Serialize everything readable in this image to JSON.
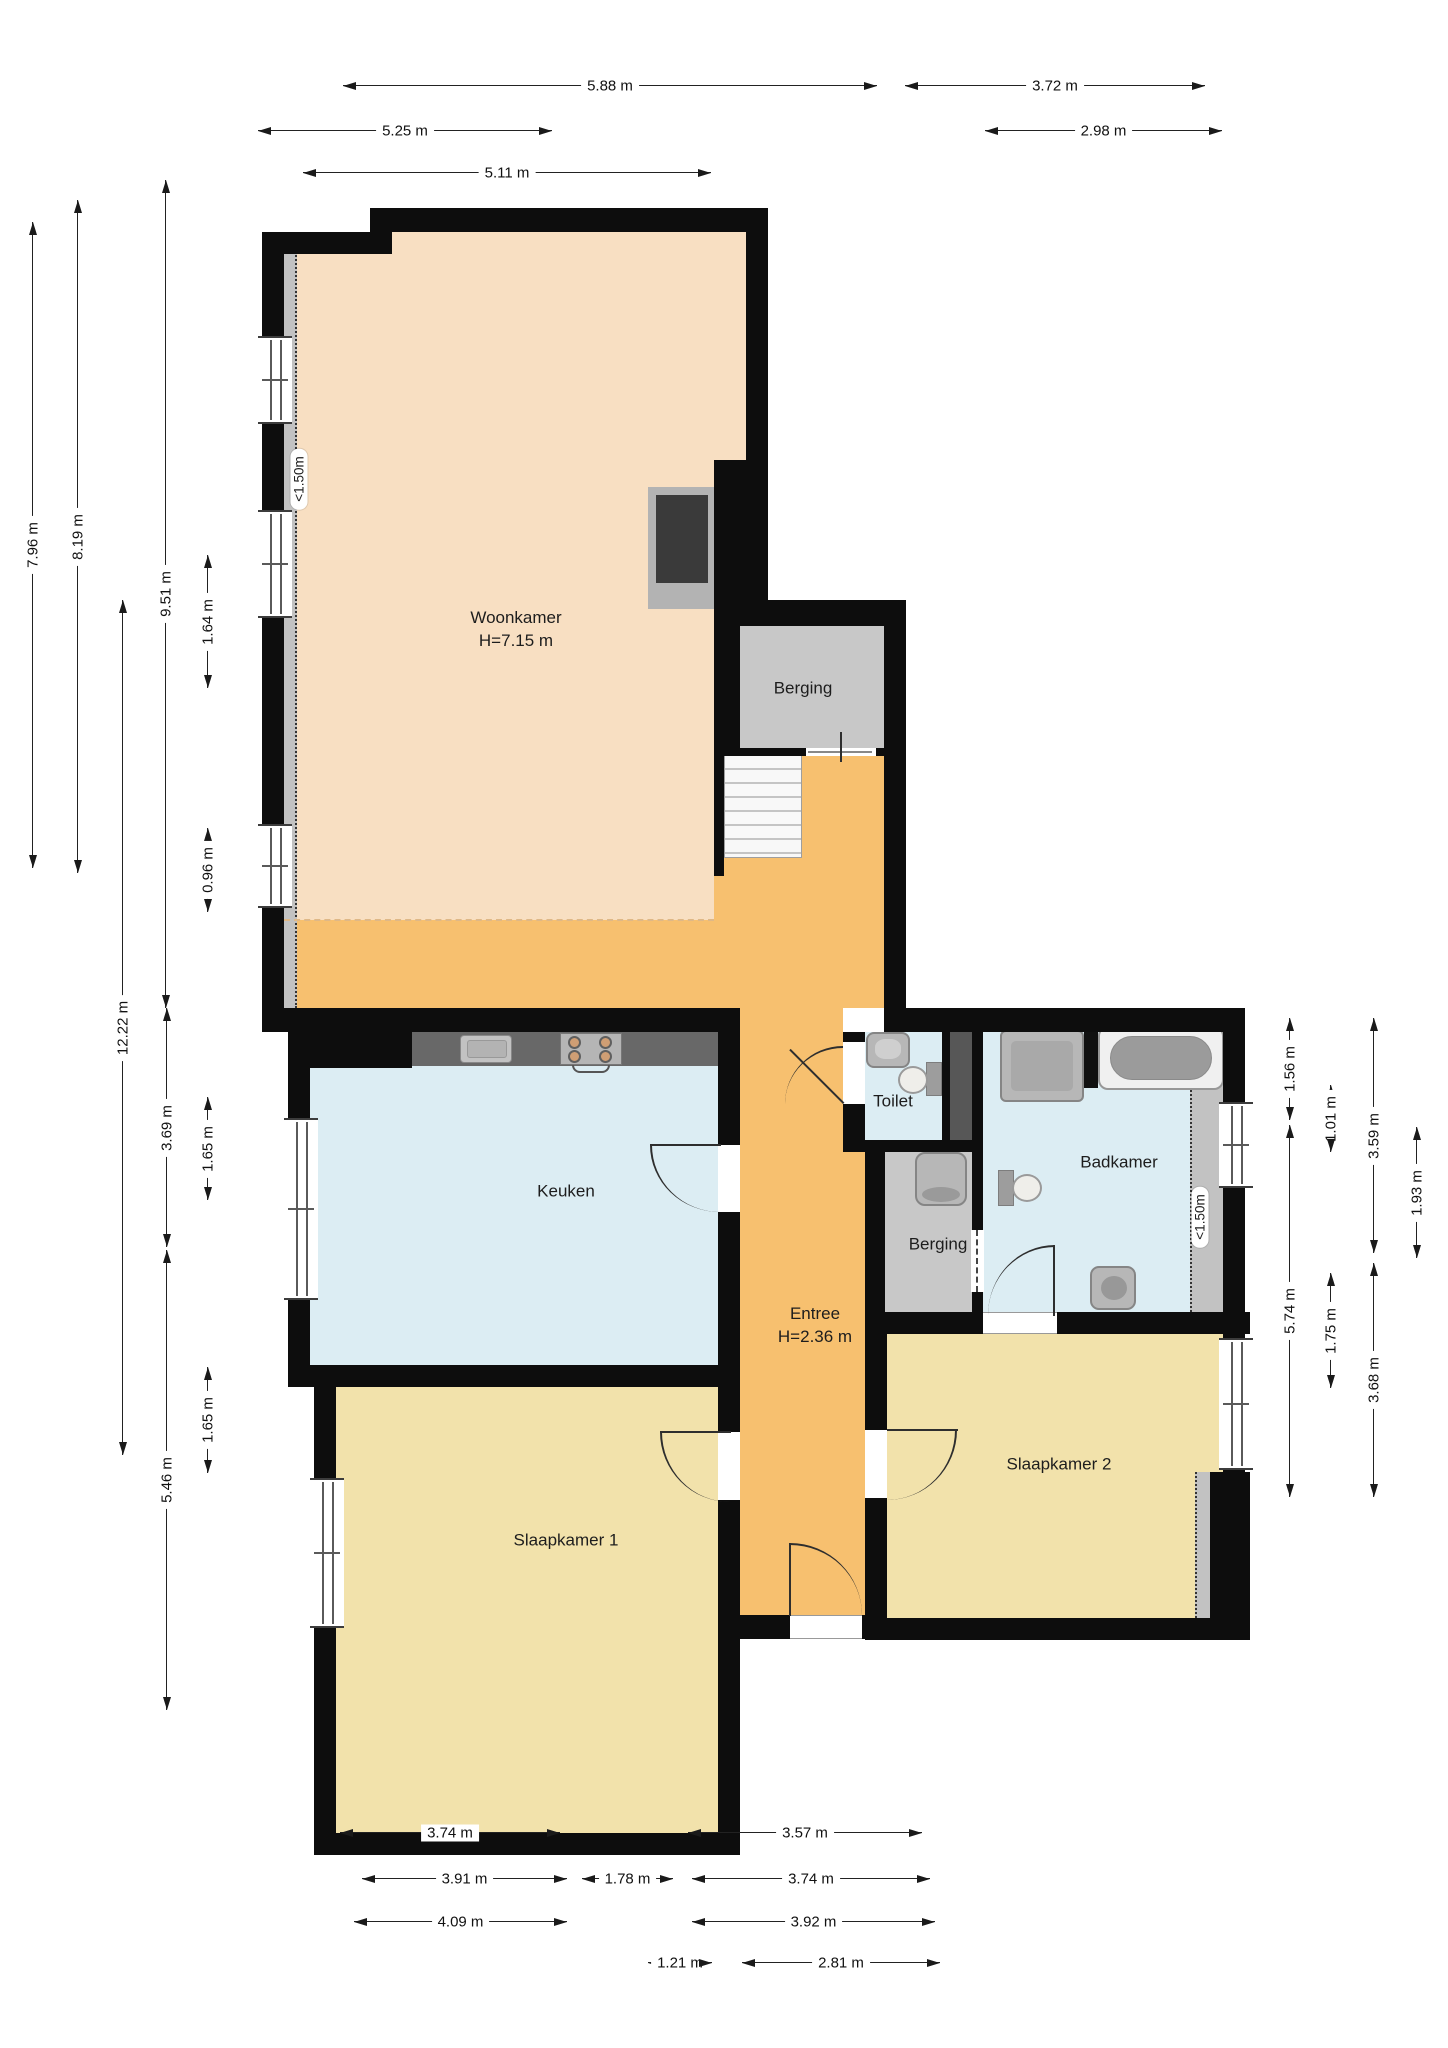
{
  "rooms": {
    "woonkamer": {
      "label": "Woonkamer",
      "height": "H=7.15 m"
    },
    "berging_boven": {
      "label": "Berging"
    },
    "keuken": {
      "label": "Keuken"
    },
    "toilet": {
      "label": "Toilet"
    },
    "badkamer": {
      "label": "Badkamer"
    },
    "berging_klein": {
      "label": "Berging"
    },
    "entree": {
      "label": "Entree",
      "height": "H=2.36 m"
    },
    "slaapkamer1": {
      "label": "Slaapkamer 1"
    },
    "slaapkamer2": {
      "label": "Slaapkamer 2"
    }
  },
  "annotations": {
    "low_ceiling_woonkamer": "<1.50m",
    "low_ceiling_badkamer": "<1.50m"
  },
  "dims": {
    "top": [
      "5.88 m",
      "3.72 m",
      "5.25 m",
      "2.98 m",
      "5.11 m"
    ],
    "left": [
      "7.96 m",
      "8.19 m",
      "12.22 m",
      "9.51 m",
      "1.64 m",
      "0.96 m",
      "3.69 m",
      "1.65 m",
      "5.46 m",
      "1.65 m"
    ],
    "right": [
      "1.56 m",
      "1.01 m",
      "3.59 m",
      "1.93 m",
      "5.74 m",
      "1.75 m",
      "3.68 m"
    ],
    "bottom": [
      "3.74 m",
      "3.57 m",
      "3.91 m",
      "1.78 m",
      "3.74 m",
      "4.09 m",
      "3.92 m",
      "1.21 m",
      "2.81 m"
    ]
  },
  "colors": {
    "wall": "#0d0d0d",
    "woonkamer_floor": "#f8dfc2",
    "entree_floor": "#f7c06f",
    "keuken_badkamer_floor": "#dcedf3",
    "berging_floor": "#c8c8c8",
    "slaapkamer_floor": "#f2e2ab",
    "counter": "#686868",
    "low_ceiling_strip": "#c2c2c2"
  }
}
